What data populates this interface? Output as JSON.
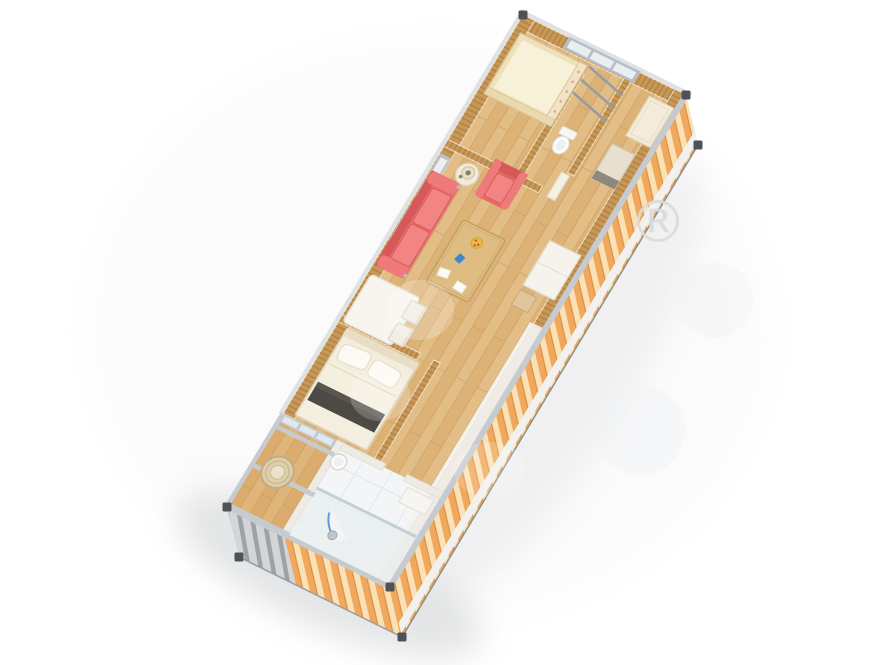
{
  "scene": {
    "background_color": "#ffffff",
    "view": "isometric-top-down-cutaway",
    "subject": "container-house-interior-floor-plan-render",
    "watermark": {
      "symbol": "®"
    }
  },
  "palette": {
    "floor_wood": "#e3bd86",
    "wall_wood": "#c79756",
    "exterior_corrugation": "#f0a85c",
    "exterior_corrugation_light": "#fbe2b6",
    "frame_metal": "#c6cbd0",
    "corner_fitting": "#4e5256",
    "sofa_red": "#e96a6a",
    "cushion_red": "#f28484",
    "bed_linen": "#f3edde",
    "bed_runner": "#4d4944",
    "bathroom_tile": "#f3f5f6",
    "glass_pane": "#dfeaee",
    "shower_hose_blue": "#5b9bd5",
    "crib_wood": "#efe0ba",
    "dining_white": "#f8f5ef",
    "wicker": "#decfad",
    "watermark_gray": "#d9dbde"
  },
  "rooms": [
    {
      "name": "kids-room",
      "position": "top-end",
      "items": [
        "crib",
        "barred-window",
        "drying-rack"
      ]
    },
    {
      "name": "toilet-nook",
      "position": "top-end-right",
      "items": [
        "toilet"
      ]
    },
    {
      "name": "hallway",
      "position": "right-side",
      "items": [
        "leaning-door-panel",
        "cabinet",
        "white-storage-unit",
        "wood-box"
      ]
    },
    {
      "name": "living-room",
      "position": "upper-middle",
      "items": [
        "red-sofa",
        "red-armchair",
        "round-side-table",
        "table-lamp",
        "coffee-table",
        "fruit-bowl",
        "blue-toy",
        "papers",
        "left-wall-windows"
      ]
    },
    {
      "name": "dining-area",
      "position": "middle-left",
      "items": [
        "white-dining-table",
        "dining-chair",
        "dining-chair"
      ]
    },
    {
      "name": "bedroom",
      "position": "lower-middle",
      "items": [
        "double-bed",
        "pillows",
        "dark-runner",
        "white-door-leaf",
        "washbasin"
      ]
    },
    {
      "name": "bathroom",
      "position": "bottom-end-right",
      "items": [
        "shower-set",
        "glass-partition",
        "wall-shelf"
      ]
    },
    {
      "name": "balcony",
      "position": "bottom-end-left",
      "items": [
        "wicker-chair",
        "glass-sliding-doors",
        "metal-frame-railing"
      ]
    }
  ],
  "structure": {
    "frame": "steel-frame-with-corner-fittings",
    "side_cladding": "corrugated-panels",
    "floor": "wood-planks"
  }
}
